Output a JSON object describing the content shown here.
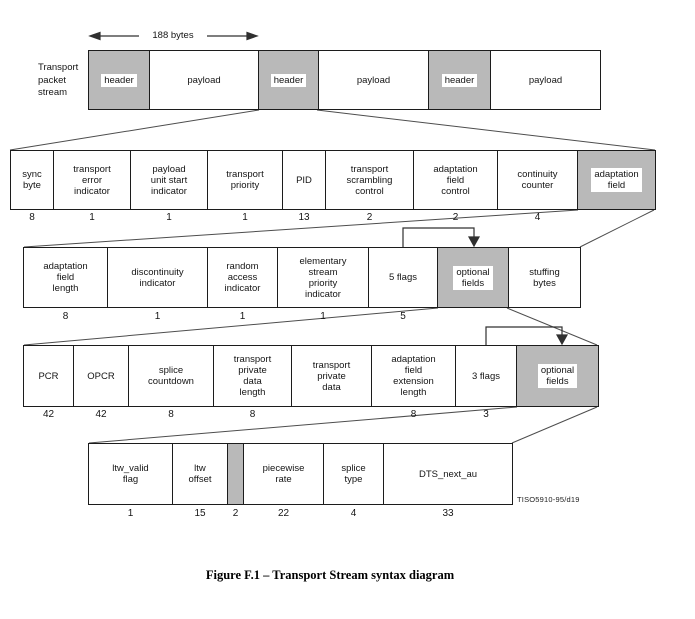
{
  "figure": {
    "caption": "Figure F.1 – Transport Stream syntax diagram",
    "watermark": "TISO5910-95/d19"
  },
  "colors": {
    "box_fill_gray": "#b9b9b9",
    "box_border": "#1c1c1c",
    "connector_line": "#4d4d4d"
  },
  "packet_stream": {
    "label": "Transport\npacket\nstream",
    "arrow_label": "188 bytes",
    "cells": [
      {
        "label": "header"
      },
      {
        "label": "payload"
      },
      {
        "label": "header"
      },
      {
        "label": "payload"
      },
      {
        "label": "header"
      },
      {
        "label": "payload"
      }
    ]
  },
  "ts_header": {
    "cells": [
      {
        "label": "sync\nbyte",
        "bits": "8"
      },
      {
        "label": "transport\nerror\nindicator",
        "bits": "1"
      },
      {
        "label": "payload\nunit start\nindicator",
        "bits": "1"
      },
      {
        "label": "transport\npriority",
        "bits": "1"
      },
      {
        "label": "PID",
        "bits": "13"
      },
      {
        "label": "transport\nscrambling\ncontrol",
        "bits": "2"
      },
      {
        "label": "adaptation\nfield\ncontrol",
        "bits": "2"
      },
      {
        "label": "continuity\ncounter",
        "bits": "4"
      },
      {
        "label": "adaptation\nfield",
        "bits": ""
      }
    ]
  },
  "adaptation_field": {
    "cells": [
      {
        "label": "adaptation\nfield\nlength",
        "bits": "8"
      },
      {
        "label": "discontinuity\nindicator",
        "bits": "1"
      },
      {
        "label": "random\naccess\nindicator",
        "bits": "1"
      },
      {
        "label": "elementary\nstream\npriority\nindicator",
        "bits": "1"
      },
      {
        "label": "5 flags",
        "bits": "5"
      },
      {
        "label": "optional\nfields",
        "bits": ""
      },
      {
        "label": "stuffing\nbytes",
        "bits": ""
      }
    ]
  },
  "af_optional": {
    "cells": [
      {
        "label": "PCR",
        "bits": "42"
      },
      {
        "label": "OPCR",
        "bits": "42"
      },
      {
        "label": "splice\ncountdown",
        "bits": "8"
      },
      {
        "label": "transport\nprivate\ndata\nlength",
        "bits": "8"
      },
      {
        "label": "transport\nprivate\ndata",
        "bits": ""
      },
      {
        "label": "adaptation\nfield\nextension\nlength",
        "bits": "8"
      },
      {
        "label": "3 flags",
        "bits": "3"
      },
      {
        "label": "optional\nfields",
        "bits": ""
      }
    ]
  },
  "af_extension_optional": {
    "cells": [
      {
        "label": "ltw_valid\nflag",
        "bits": "1"
      },
      {
        "label": "ltw\noffset",
        "bits": "15"
      },
      {
        "label": "",
        "bits": "2"
      },
      {
        "label": "piecewise\nrate",
        "bits": "22"
      },
      {
        "label": "splice\ntype",
        "bits": "4"
      },
      {
        "label": "DTS_next_au",
        "bits": "33"
      }
    ]
  }
}
